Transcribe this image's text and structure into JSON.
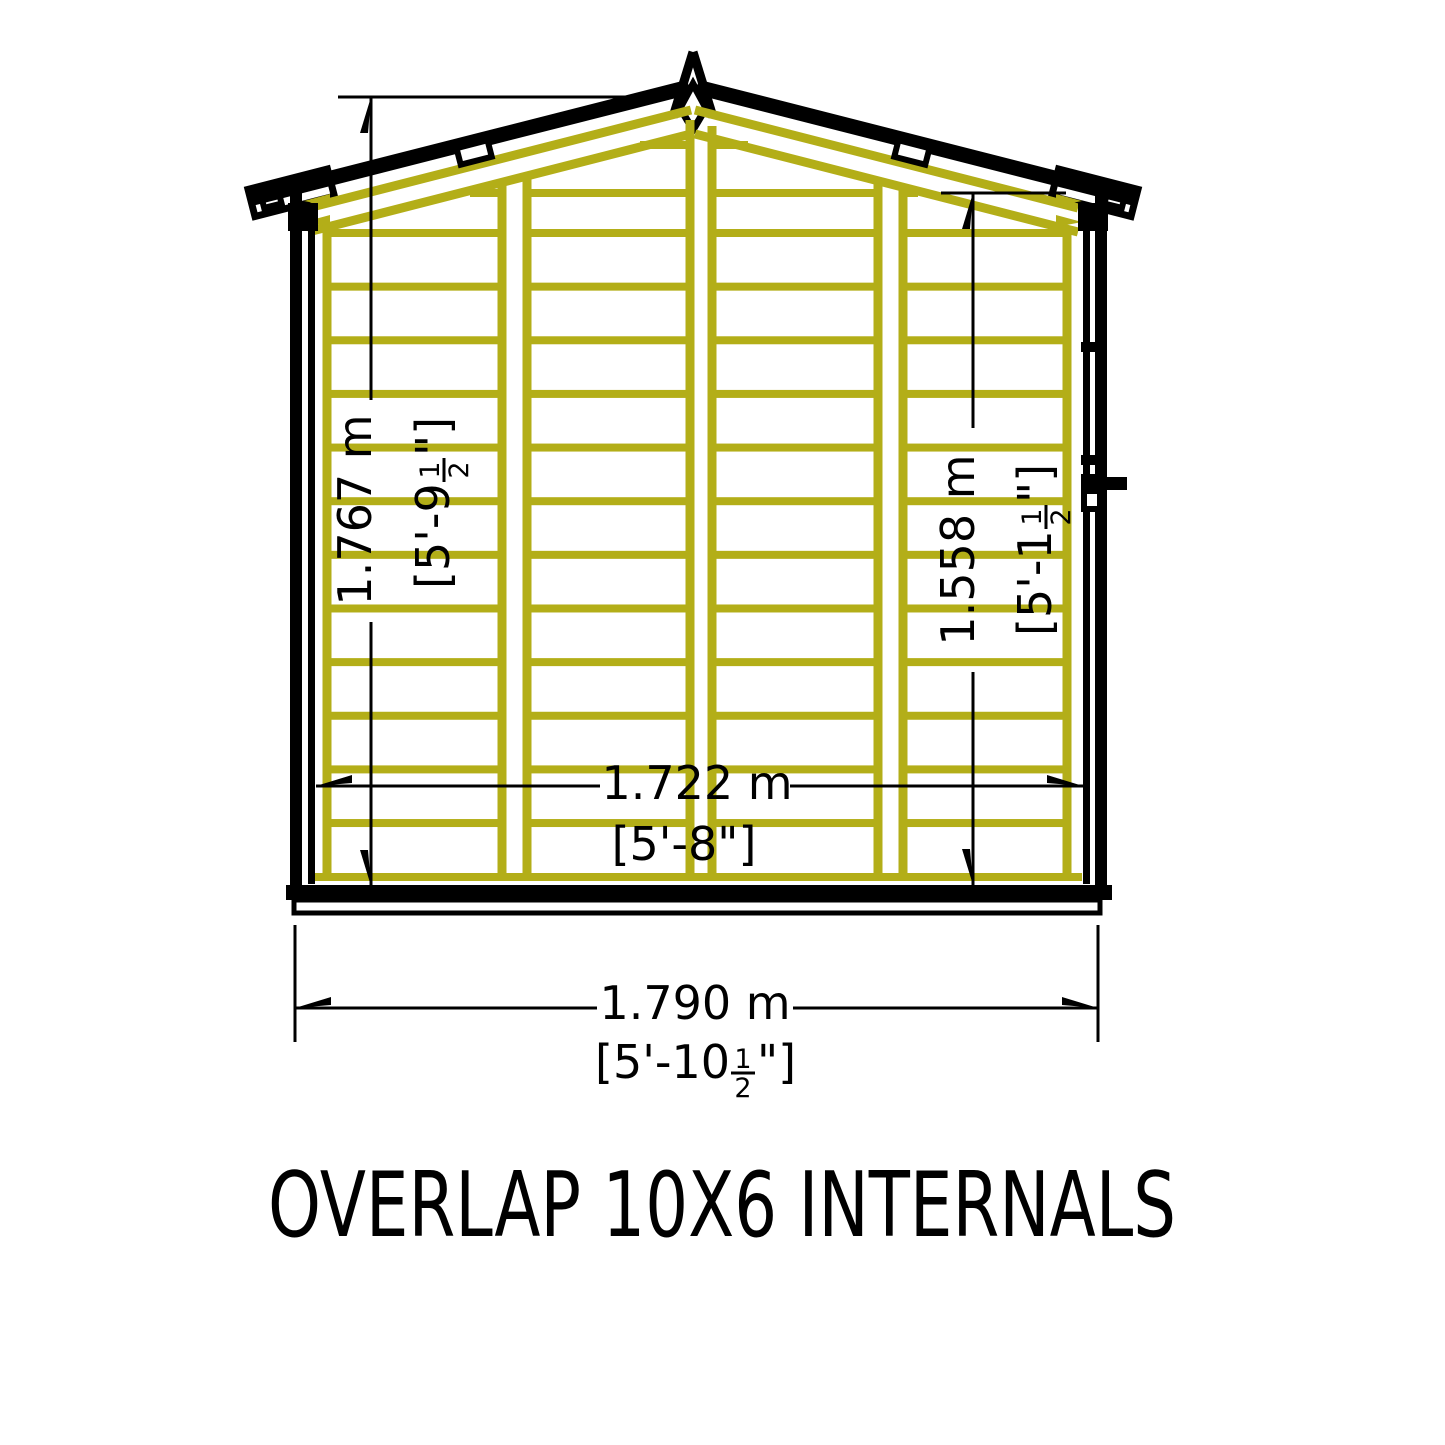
{
  "title": "OVERLAP 10X6 INTERNALS",
  "drawing": {
    "description": "Technical front-elevation drawing of shed internal timber framing",
    "colors": {
      "outline": "#000000",
      "framing": "#b3ae18",
      "background": "#ffffff"
    },
    "dimensions": {
      "ridge_height": {
        "metric": "1.767 m",
        "imperial_prefix": "[5'-9",
        "fraction_numerator": "1",
        "fraction_denominator": "2",
        "imperial_suffix": "\"]"
      },
      "eaves_height": {
        "metric": "1.558 m",
        "imperial_prefix": "[5'-1",
        "fraction_numerator": "1",
        "fraction_denominator": "2",
        "imperial_suffix": "\"]"
      },
      "internal_width": {
        "metric": "1.722 m",
        "imperial": "[5'-8\"]"
      },
      "external_width": {
        "metric": "1.790 m",
        "imperial_prefix": "[5'-10",
        "fraction_numerator": "1",
        "fraction_denominator": "2",
        "imperial_suffix": "\"]"
      }
    }
  }
}
